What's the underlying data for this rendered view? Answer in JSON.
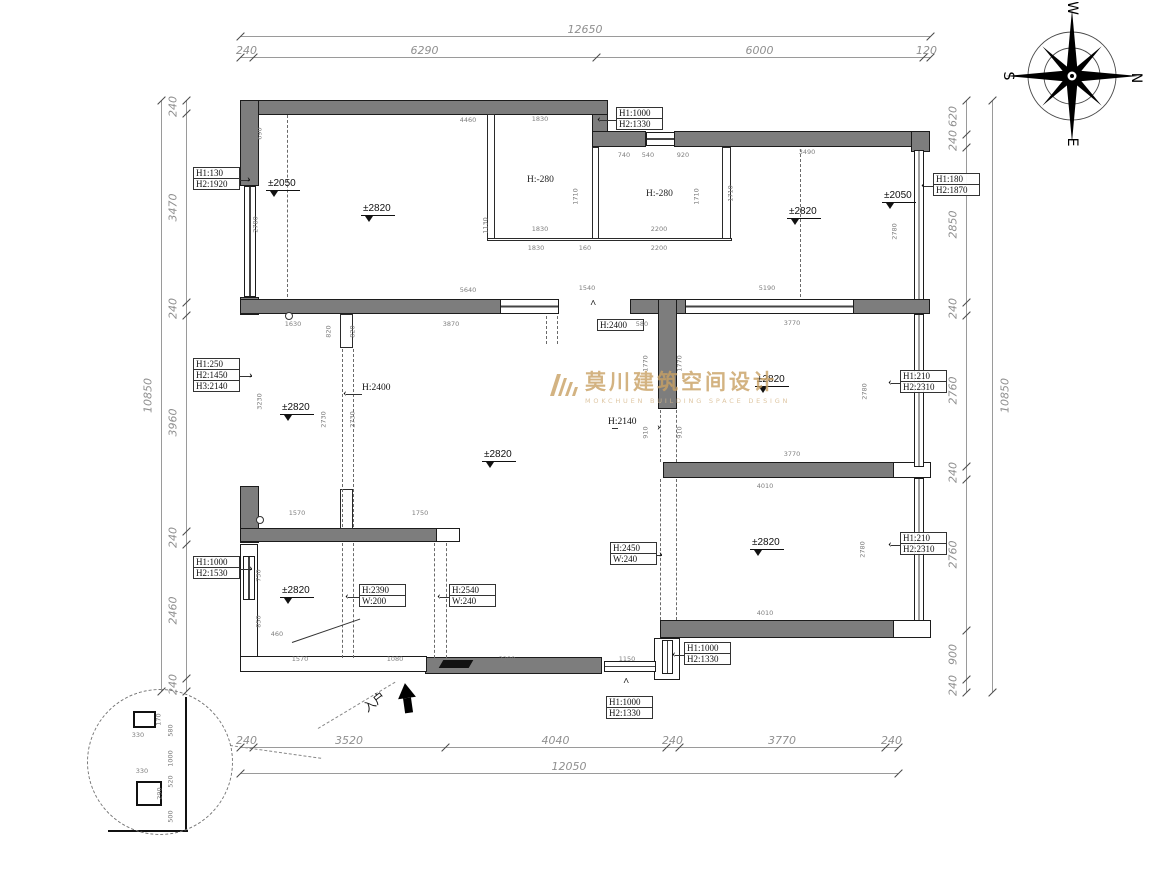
{
  "watermark": {
    "cn": "莫川建筑空间设计",
    "en": "MOKCHUEN BUILDING SPACE DESIGN",
    "color": "#c9a163"
  },
  "compass": {
    "top": "W",
    "right": "N",
    "bottom": "E",
    "left": "S"
  },
  "entry_label": "入户",
  "wall_color": "#7d7d7d",
  "dims": {
    "top": {
      "overall": "12650",
      "segments": [
        "240",
        "6290",
        "6000",
        "120"
      ]
    },
    "bottom": {
      "overall": "12050",
      "segments": [
        "240",
        "3520",
        "4040",
        "240",
        "3770",
        "240"
      ]
    },
    "left": {
      "overall": "10850",
      "segments": [
        "240",
        "3470",
        "240",
        "3960",
        "240",
        "2460",
        "240"
      ]
    },
    "right": {
      "overall": "10850",
      "segments": [
        "620",
        "240",
        "2850",
        "240",
        "2760",
        "240",
        "2760",
        "900",
        "240"
      ]
    }
  },
  "levels": [
    {
      "t": "±2050",
      "x": 266,
      "y": 178
    },
    {
      "t": "±2820",
      "x": 361,
      "y": 203
    },
    {
      "t": "±2820",
      "x": 787,
      "y": 206
    },
    {
      "t": "±2050",
      "x": 882,
      "y": 190
    },
    {
      "t": "±2820",
      "x": 280,
      "y": 402
    },
    {
      "t": "±2820",
      "x": 482,
      "y": 449
    },
    {
      "t": "±2820",
      "x": 755,
      "y": 374
    },
    {
      "t": "±2820",
      "x": 750,
      "y": 537
    },
    {
      "t": "±2820",
      "x": 280,
      "y": 585
    }
  ],
  "floor_heights": [
    {
      "t": "H:-280",
      "x": 527,
      "y": 175
    },
    {
      "t": "H:-280",
      "x": 646,
      "y": 189
    }
  ],
  "height_arrows": [
    {
      "t": "H:2400",
      "x": 362,
      "y": 383,
      "dir": "left",
      "ax": 346,
      "ay": 393
    },
    {
      "t": "H:2140",
      "x": 608,
      "y": 417,
      "dir": "right",
      "ax": 660,
      "ay": 427
    }
  ],
  "callouts": [
    {
      "lines": [
        "H1:130",
        "H2:1920"
      ],
      "x": 193,
      "y": 168,
      "arrow": "right",
      "ax": 250,
      "ay": 179
    },
    {
      "lines": [
        "H1:1000",
        "H2:1330"
      ],
      "x": 616,
      "y": 108,
      "arrow": "left",
      "ax": 600,
      "ay": 119
    },
    {
      "lines": [
        "H1:180",
        "H2:1870"
      ],
      "x": 933,
      "y": 174,
      "arrow": "left",
      "ax": 924,
      "ay": 185
    },
    {
      "lines": [
        "H1:250",
        "H2:1450",
        "H3:2140"
      ],
      "x": 193,
      "y": 359,
      "arrow": "right",
      "ax": 252,
      "ay": 375
    },
    {
      "lines": [
        "H1:210",
        "H2:2310"
      ],
      "x": 900,
      "y": 371,
      "arrow": "left",
      "ax": 891,
      "ay": 382
    },
    {
      "lines": [
        "H1:210",
        "H2:2310"
      ],
      "x": 900,
      "y": 533,
      "arrow": "left",
      "ax": 891,
      "ay": 544
    },
    {
      "lines": [
        "H1:1000",
        "H2:1530"
      ],
      "x": 193,
      "y": 557,
      "arrow": "right",
      "ax": 252,
      "ay": 568
    },
    {
      "lines": [
        "H:2390",
        "W:200"
      ],
      "x": 359,
      "y": 585,
      "arrow": "left",
      "ax": 348,
      "ay": 596
    },
    {
      "lines": [
        "H:2540",
        "W:240"
      ],
      "x": 449,
      "y": 585,
      "arrow": "left",
      "ax": 440,
      "ay": 596
    },
    {
      "lines": [
        "H:2450",
        "W:240"
      ],
      "x": 610,
      "y": 543,
      "arrow": "right",
      "ax": 662,
      "ay": 554
    },
    {
      "lines": [
        "H1:1000",
        "H2:1330"
      ],
      "x": 684,
      "y": 643,
      "arrow": "left",
      "ax": 675,
      "ay": 654
    },
    {
      "lines": [
        "H1:1000",
        "H2:1330"
      ],
      "x": 606,
      "y": 697,
      "arrow": "up",
      "ax": 626,
      "ay": 682
    },
    {
      "lines": [
        "H:2400"
      ],
      "x": 597,
      "y": 320,
      "arrow": "up",
      "ax": 593,
      "ay": 304
    }
  ],
  "interior_dims": [
    {
      "t": "4460",
      "x": 468,
      "y": 117
    },
    {
      "t": "690",
      "x": 260,
      "y": 130,
      "r": 1
    },
    {
      "t": "2780",
      "x": 256,
      "y": 221,
      "r": 1
    },
    {
      "t": "1130",
      "x": 486,
      "y": 222,
      "r": 1
    },
    {
      "t": "5640",
      "x": 468,
      "y": 287
    },
    {
      "t": "1830",
      "x": 540,
      "y": 116
    },
    {
      "t": "1710",
      "x": 576,
      "y": 193,
      "r": 1
    },
    {
      "t": "1830",
      "x": 540,
      "y": 226
    },
    {
      "t": "1830",
      "x": 536,
      "y": 245
    },
    {
      "t": "160",
      "x": 585,
      "y": 245
    },
    {
      "t": "740",
      "x": 624,
      "y": 152
    },
    {
      "t": "540",
      "x": 648,
      "y": 152
    },
    {
      "t": "920",
      "x": 683,
      "y": 152
    },
    {
      "t": "1710",
      "x": 697,
      "y": 193,
      "r": 1
    },
    {
      "t": "1710",
      "x": 731,
      "y": 190,
      "r": 1
    },
    {
      "t": "2200",
      "x": 659,
      "y": 226
    },
    {
      "t": "2200",
      "x": 659,
      "y": 245
    },
    {
      "t": "3490",
      "x": 807,
      "y": 149
    },
    {
      "t": "2780",
      "x": 895,
      "y": 228,
      "r": 1
    },
    {
      "t": "5190",
      "x": 767,
      "y": 285
    },
    {
      "t": "1540",
      "x": 587,
      "y": 285
    },
    {
      "t": "1630",
      "x": 293,
      "y": 321
    },
    {
      "t": "820",
      "x": 329,
      "y": 328,
      "r": 1
    },
    {
      "t": "820",
      "x": 353,
      "y": 328,
      "r": 1
    },
    {
      "t": "3870",
      "x": 451,
      "y": 321
    },
    {
      "t": "580",
      "x": 642,
      "y": 321
    },
    {
      "t": "3770",
      "x": 792,
      "y": 320
    },
    {
      "t": "3230",
      "x": 260,
      "y": 398,
      "r": 1
    },
    {
      "t": "2730",
      "x": 324,
      "y": 416,
      "r": 1
    },
    {
      "t": "2730",
      "x": 353,
      "y": 416,
      "r": 1
    },
    {
      "t": "1770",
      "x": 646,
      "y": 360,
      "r": 1
    },
    {
      "t": "1770",
      "x": 680,
      "y": 360,
      "r": 1
    },
    {
      "t": "2780",
      "x": 865,
      "y": 388,
      "r": 1
    },
    {
      "t": "3770",
      "x": 792,
      "y": 451
    },
    {
      "t": "910",
      "x": 646,
      "y": 429,
      "r": 1
    },
    {
      "t": "910",
      "x": 680,
      "y": 429,
      "r": 1
    },
    {
      "t": "4010",
      "x": 765,
      "y": 483
    },
    {
      "t": "2780",
      "x": 863,
      "y": 546,
      "r": 1
    },
    {
      "t": "1570",
      "x": 297,
      "y": 510
    },
    {
      "t": "1750",
      "x": 420,
      "y": 510
    },
    {
      "t": "730",
      "x": 259,
      "y": 572,
      "r": 1
    },
    {
      "t": "850",
      "x": 259,
      "y": 618,
      "r": 1
    },
    {
      "t": "460",
      "x": 277,
      "y": 631
    },
    {
      "t": "1570",
      "x": 300,
      "y": 656
    },
    {
      "t": "1080",
      "x": 395,
      "y": 656
    },
    {
      "t": "3290",
      "x": 507,
      "y": 656
    },
    {
      "t": "1150",
      "x": 627,
      "y": 656
    },
    {
      "t": "4010",
      "x": 765,
      "y": 610
    }
  ],
  "detail_dims": [
    {
      "t": "170",
      "x": 159,
      "y": 716,
      "r": 1
    },
    {
      "t": "330",
      "x": 138,
      "y": 732
    },
    {
      "t": "580",
      "x": 171,
      "y": 727,
      "r": 1
    },
    {
      "t": "1000",
      "x": 171,
      "y": 755,
      "r": 1
    },
    {
      "t": "330",
      "x": 142,
      "y": 768
    },
    {
      "t": "520",
      "x": 171,
      "y": 778,
      "r": 1
    },
    {
      "t": "290",
      "x": 160,
      "y": 790,
      "r": 1
    },
    {
      "t": "500",
      "x": 171,
      "y": 813,
      "r": 1
    }
  ]
}
